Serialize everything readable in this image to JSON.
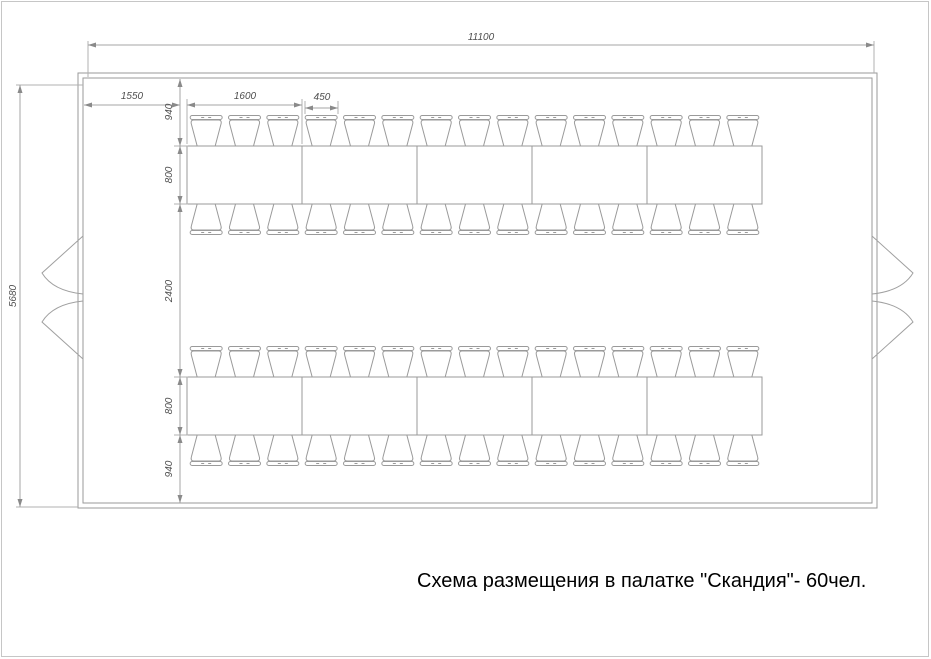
{
  "caption": {
    "text": "Схема размещения в палатке \"Скандия\"- 60чел."
  },
  "dims": {
    "tent_width": "11100",
    "tent_depth": "5680",
    "wall_to_first_table": "1550",
    "table_section_length": "1600",
    "chair_pitch": "450",
    "wall_to_table_gap": "940",
    "table_depth": "800",
    "center_aisle": "2400"
  },
  "layout": {
    "rows": 2,
    "table_sections_per_row": 5,
    "chairs_per_section_side": 3,
    "total_seats": 60
  }
}
